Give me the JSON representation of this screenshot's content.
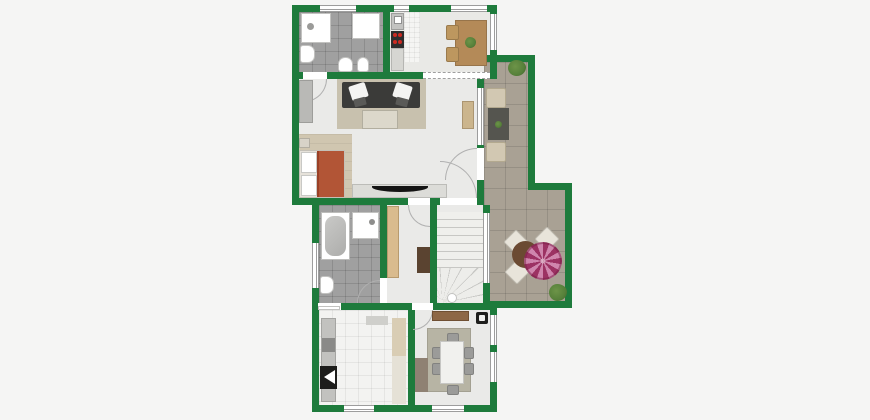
{
  "image": {
    "kind": "residential floor plan, top-down, furnished, no text labels",
    "wall_style": "solid green walls with white windows and door swing arcs"
  },
  "palette": {
    "background": "#f5f5f4",
    "wall": "#1e7b3c",
    "floor_light": "#eaeae8",
    "floor_kitchen": "#e9e9e6",
    "tile_gray": "#a0a0a0",
    "terrace_tile": "#a9a194",
    "laundry_tile": "#f3f3f1",
    "wood_floor": "#d0c6b0",
    "rug_beige": "#c8c1ae",
    "rug_green": "#b7b4a4",
    "sofa_dark": "#3b3b39",
    "bed_blanket": "#b25536",
    "wood_furniture": "#b48a58",
    "sideboard_wood": "#8d6746",
    "wardrobe_tan": "#d9bb8e",
    "dresser_brown": "#5a4330",
    "taupe_cabinet": "#8f8173",
    "stove_black": "#2e2e2e",
    "burner_red": "#cc2a22",
    "umbrella_pink": "#9c3263",
    "umbrella_pink_light": "#cf86ad",
    "plant_green": "#56803a",
    "terrace_table": "#55554f",
    "white_fixture": "#ffffff",
    "door_arc": "#b0b0b0",
    "window_frame": "#9d9d9d"
  },
  "rooms": [
    {
      "name": "bathroom-top",
      "floor": "gray tile",
      "fixtures": [
        "shower",
        "wall-cabinet",
        "sink",
        "toilet",
        "bidet"
      ]
    },
    {
      "name": "kitchen-dining-top",
      "floor": "light with speckled strip",
      "fixtures": [
        "sink-unit",
        "stove-4-burners",
        "counter",
        "wood-table",
        "2-chairs",
        "table-plant"
      ]
    },
    {
      "name": "living-room",
      "floor": "light",
      "fixtures": [
        "beige-rug",
        "dark-sofa-2-cushions",
        "coffee-table",
        "tv-sideboard",
        "tv",
        "wall-cabinet",
        "side-console"
      ]
    },
    {
      "name": "bed-nook",
      "floor": "wood",
      "fixtures": [
        "bed-orange-blanket",
        "pillows",
        "nightstand"
      ]
    },
    {
      "name": "bathroom-lower",
      "floor": "gray tile",
      "fixtures": [
        "bathtub",
        "shower",
        "sink"
      ]
    },
    {
      "name": "hallway",
      "floor": "light",
      "fixtures": [
        "tan-wardrobe",
        "brown-dresser"
      ]
    },
    {
      "name": "staircase",
      "floor": "light",
      "fixtures": [
        "straight-treads",
        "winder-fan",
        "newel-post"
      ]
    },
    {
      "name": "laundry-room",
      "floor": "white tile",
      "fixtures": [
        "counter",
        "appliance",
        "black-appliance-triangle",
        "mat",
        "runner"
      ]
    },
    {
      "name": "dining-room",
      "floor": "light",
      "fixtures": [
        "wood-sideboard",
        "black-unit",
        "green-rug",
        "white-table",
        "6-chairs",
        "taupe-cabinet"
      ]
    },
    {
      "name": "terrace",
      "floor": "stone tile L-shape",
      "fixtures": [
        "bush-top",
        "lounge-table",
        "2-lounge-chairs",
        "round-table",
        "pink-parasol",
        "3-bistro-chairs",
        "bush-bottom"
      ]
    }
  ],
  "openings": {
    "windows": 11,
    "door_arcs": 7,
    "open_passage_dashed": "between top kitchen-dining and living room"
  }
}
